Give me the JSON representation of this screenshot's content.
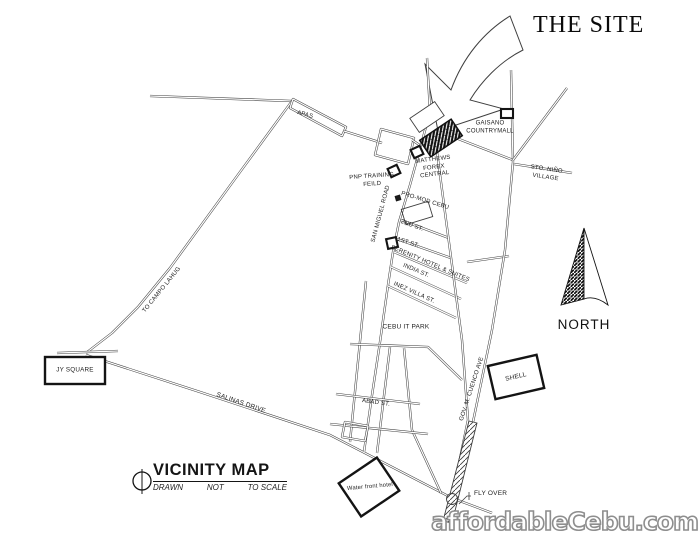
{
  "title": {
    "the_site": "THE SITE"
  },
  "labels": {
    "apas": "APAS",
    "gaisano": "GAISANO COUNTRYMALL",
    "matthews": "MATTHEWS FOREX CENTRAL",
    "pnp_training": "PNP TRAINING FEILD",
    "san_miguel": "SAN MIGUEL ROAD",
    "promod": "PRO-MOD CEBU",
    "second_st": "2ND ST.",
    "first_st": "1ST ST.",
    "serenity": "SERENITY HOTEL & SUITES",
    "india_st": "INDIA ST.",
    "inez_villa": "INEZ VILLA ST.",
    "cebu_it_park": "CEBU IT PARK",
    "abad_st": "ABAD ST.",
    "gov_cuenco": "GOV. M. CUENCO AVE",
    "sto_nino": "STO. NIÑO VILLAGE",
    "north": "NORTH",
    "shell": "SHELL",
    "jy_square": "JY SQUARE",
    "salinas": "SALINAS DRIVE",
    "to_campo": "TO CAMPO LAHUG",
    "water_front": "Water front hotel",
    "fly_over": "FLY OVER"
  },
  "legend": {
    "title": "VICINITY MAP",
    "note_drawn": "DRAWN",
    "note_not": "NOT",
    "note_scale": "TO SCALE"
  },
  "watermark": {
    "text": "affordableCebu.com"
  },
  "colors": {
    "line": "#3f3f3f",
    "watermark_outline": "#8e8e8e",
    "background": "#ffffff"
  }
}
